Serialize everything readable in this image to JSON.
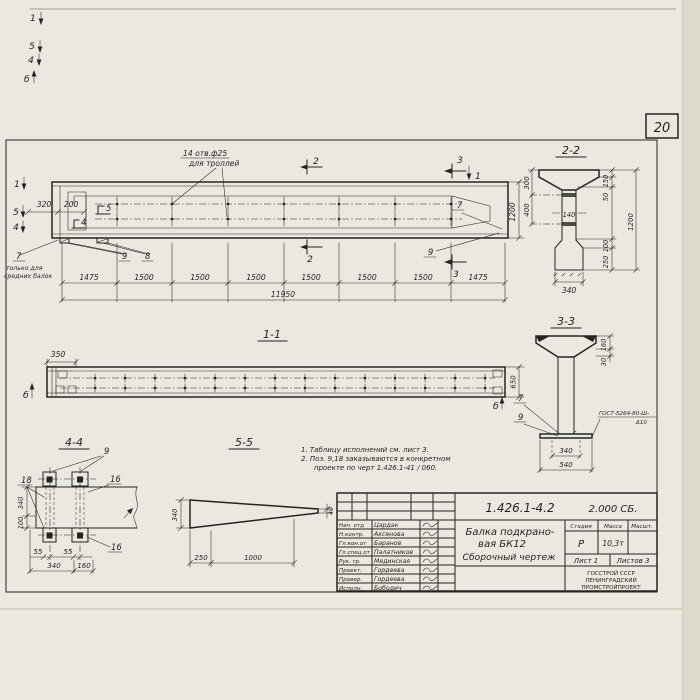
{
  "colors": {
    "paper": "#ebe8df",
    "ink": "#262420"
  },
  "page": {
    "sheet_number": "20"
  },
  "margin_marks": {
    "m1": "1",
    "m5": "5",
    "m4": "4",
    "mb": "б"
  },
  "elevation": {
    "hole_note_1": "14 отв.ф25",
    "hole_note_2": "для троллей",
    "cut_1": "1",
    "cut_2": "2",
    "cut_3": "3",
    "cut_4": "4",
    "cut_5": "5",
    "callout_7": "7",
    "callout_8": "8",
    "callout_9": "9",
    "left_note_1": "только для",
    "left_note_2": "средних балок",
    "dim_320": "320",
    "dim_200": "200",
    "dim_1200": "1200",
    "dims_row": [
      "1475",
      "1500",
      "1500",
      "1500",
      "1500",
      "1500",
      "1500",
      "1475"
    ],
    "dim_total": "11950"
  },
  "section22": {
    "title": "2-2",
    "dim_300": "300",
    "dim_400": "400",
    "dim_140": "140",
    "dim_150": "150",
    "dim_50": "50",
    "dim_100": "100",
    "dim_250": "250",
    "dim_1200": "1200",
    "dim_340": "340"
  },
  "section33": {
    "title": "3-3",
    "dim_160": "160",
    "dim_30": "30",
    "callout_7": "7",
    "callout_9": "9",
    "weld_line1": "ГОСТ-5264-80-Ш-",
    "weld_line2": "Δ10",
    "dim_340": "340",
    "dim_540": "540"
  },
  "section11": {
    "title": "1-1",
    "dim_350": "350",
    "dim_650": "650",
    "mark_b": "б"
  },
  "section44": {
    "title": "4-4",
    "callout_9": "9",
    "callout_18": "18",
    "callout_16r": "16",
    "callout_16b": "16",
    "dim_340_left": "340",
    "dim_100": "100",
    "dim_55_1": "55",
    "dim_55_2": "55",
    "dim_340": "340",
    "dim_160": "160"
  },
  "section55": {
    "title": "5-5",
    "dim_340": "340",
    "dim_250": "250",
    "dim_1000": "1000",
    "dim_40": "40"
  },
  "notes": {
    "line1": "1. Таблицу исполнений  см. лист 3.",
    "line2": "2. Поз. 9,18 заказываются в конкретном",
    "line3": "проекте по черт 1.426.1-41 / 060."
  },
  "title_block": {
    "doc_number": "1.426.1-4.2",
    "doc_code": "2.000 СБ.",
    "title_1": "Балка подкрано-",
    "title_2": "вая БК12",
    "title_3": "Сборочный чертеж",
    "stage_label": "Стадия",
    "mass_label": "Масса",
    "scale_label": "Масшт.",
    "stage": "Р",
    "mass": "10,3т",
    "sheet": "Лист 1",
    "sheets": "Листов 3",
    "org_1": "ГОССТРОЙ СССР",
    "org_2": "ЛЕНИНГРАДСКИЙ",
    "org_3": "ПРОМСТРОЙПРОЕКТ",
    "rows": [
      {
        "role": "Нач. отд",
        "name": "Цардак"
      },
      {
        "role": "Н.контр.",
        "name": "Аксенова"
      },
      {
        "role": "Гл.кон.от",
        "name": "Баранов"
      },
      {
        "role": "Гл.спец.от",
        "name": "Палатников"
      },
      {
        "role": "Рук. гр.",
        "name": "Мединская"
      },
      {
        "role": "Проект.",
        "name": "Гордеева"
      },
      {
        "role": "Провер.",
        "name": "Гордеева"
      },
      {
        "role": "Исполн.",
        "name": "Бободич"
      }
    ]
  }
}
